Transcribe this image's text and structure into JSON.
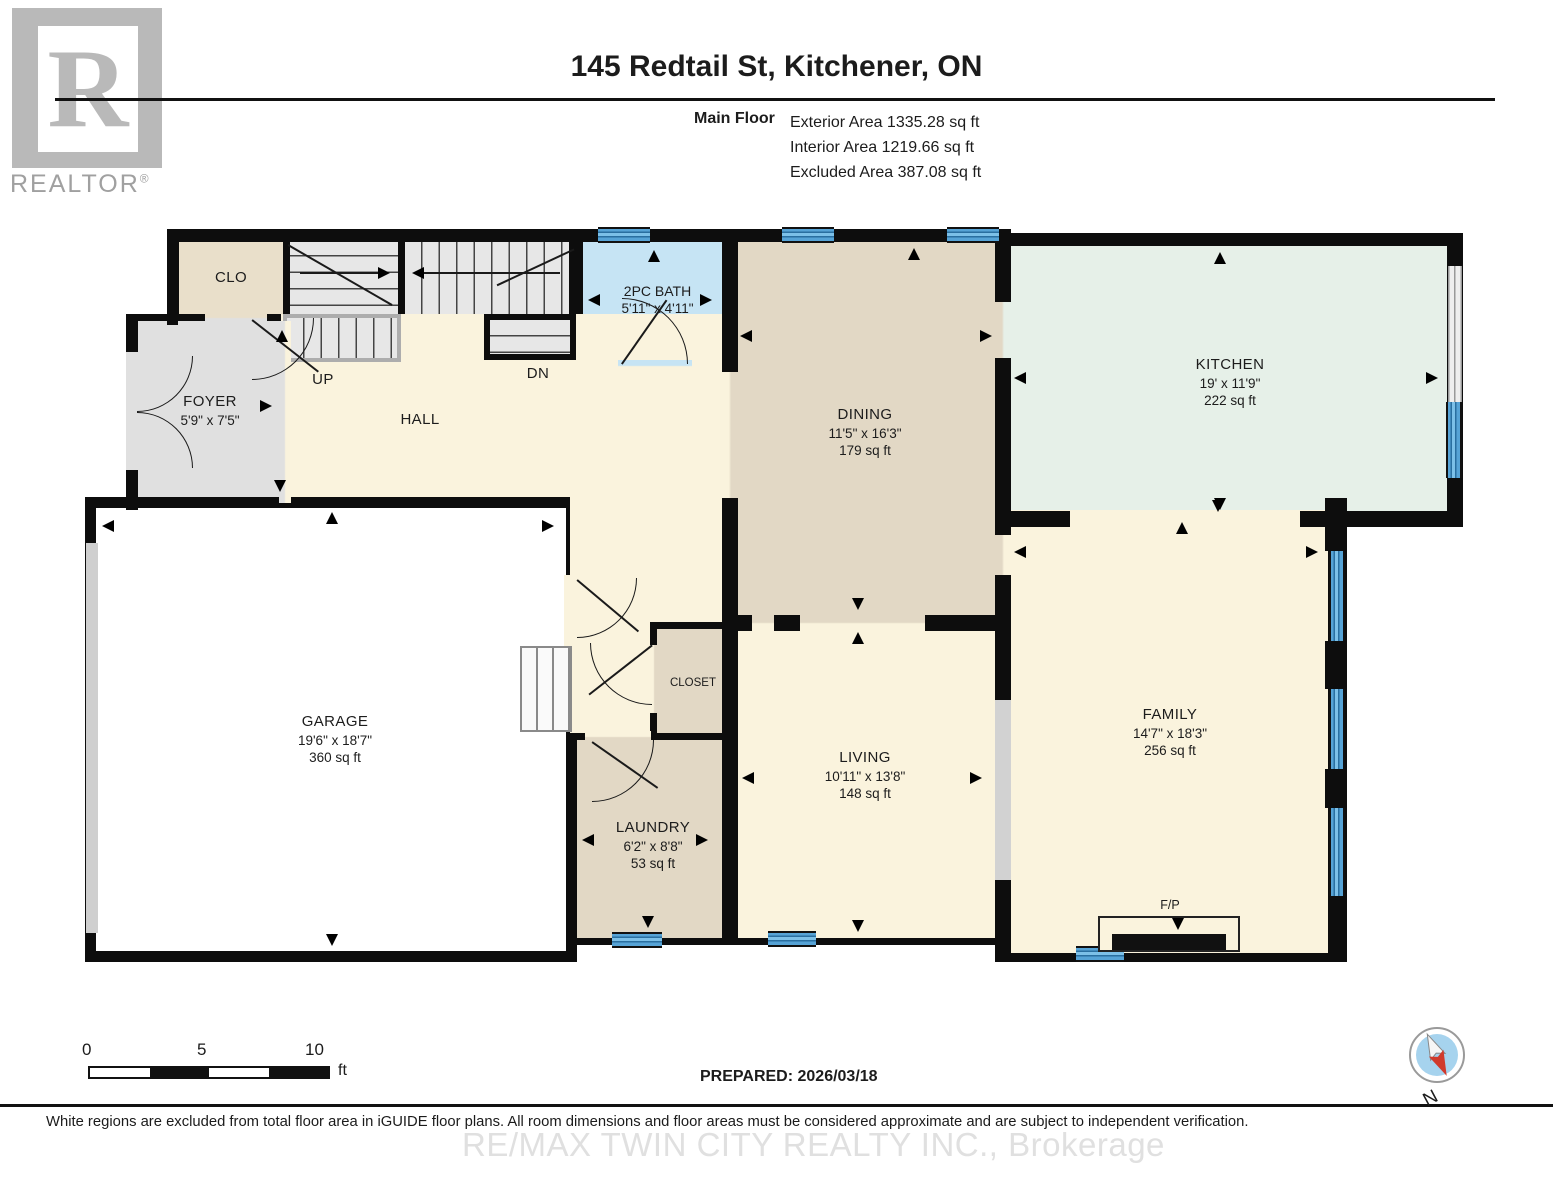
{
  "logo": {
    "brand": "REALTOR",
    "registered": "®",
    "letter": "R"
  },
  "header": {
    "title": "145 Redtail St, Kitchener, ON",
    "floor_label": "Main Floor",
    "areas": [
      "Exterior Area 1335.28 sq ft",
      "Interior Area 1219.66 sq ft",
      "Excluded Area 387.08 sq ft"
    ]
  },
  "rooms": {
    "clo": {
      "name": "CLO"
    },
    "foyer": {
      "name": "FOYER",
      "dims": "5'9\" x 7'5\""
    },
    "hall": {
      "name": "HALL"
    },
    "stairs_up": {
      "label": "UP"
    },
    "stairs_dn": {
      "label": "DN"
    },
    "bath": {
      "name": "2PC BATH",
      "dims": "5'11\" x 4'11\""
    },
    "dining": {
      "name": "DINING",
      "dims": "11'5\" x 16'3\"",
      "area": "179 sq ft"
    },
    "kitchen": {
      "name": "KITCHEN",
      "dims": "19' x 11'9\"",
      "area": "222 sq ft"
    },
    "garage": {
      "name": "GARAGE",
      "dims": "19'6\" x 18'7\"",
      "area": "360 sq ft"
    },
    "closet": {
      "name": "CLOSET"
    },
    "laundry": {
      "name": "LAUNDRY",
      "dims": "6'2\" x 8'8\"",
      "area": "53 sq ft"
    },
    "living": {
      "name": "LIVING",
      "dims": "10'11\" x 13'8\"",
      "area": "148 sq ft"
    },
    "family": {
      "name": "FAMILY",
      "dims": "14'7\" x 18'3\"",
      "area": "256 sq ft"
    },
    "fireplace": {
      "label": "F/P"
    }
  },
  "scale_bar": {
    "tick0": "0",
    "tick5": "5",
    "tick10": "10",
    "unit": "ft"
  },
  "prepared": "PREPARED: 2026/03/18",
  "compass": {
    "label": "N"
  },
  "footer": {
    "disclaimer": "White regions are excluded from total floor area in iGUIDE floor plans. All room dimensions and floor areas must be considered approximate and are subject to independent verification.",
    "watermark": "RE/MAX TWIN CITY REALTY INC., Brokerage"
  },
  "colors": {
    "wall": "#0d0d0d",
    "window_blue": "#56a3d6",
    "bath_fill": "#c6e4f4",
    "kitchen_fill": "#e6f0e8",
    "tan_fill": "#e2d8c5",
    "cream_fill": "#faf3dd",
    "gray_fill": "#e0e0e0",
    "garage_fill": "#ffffff",
    "compass_red": "#d03a2c"
  }
}
